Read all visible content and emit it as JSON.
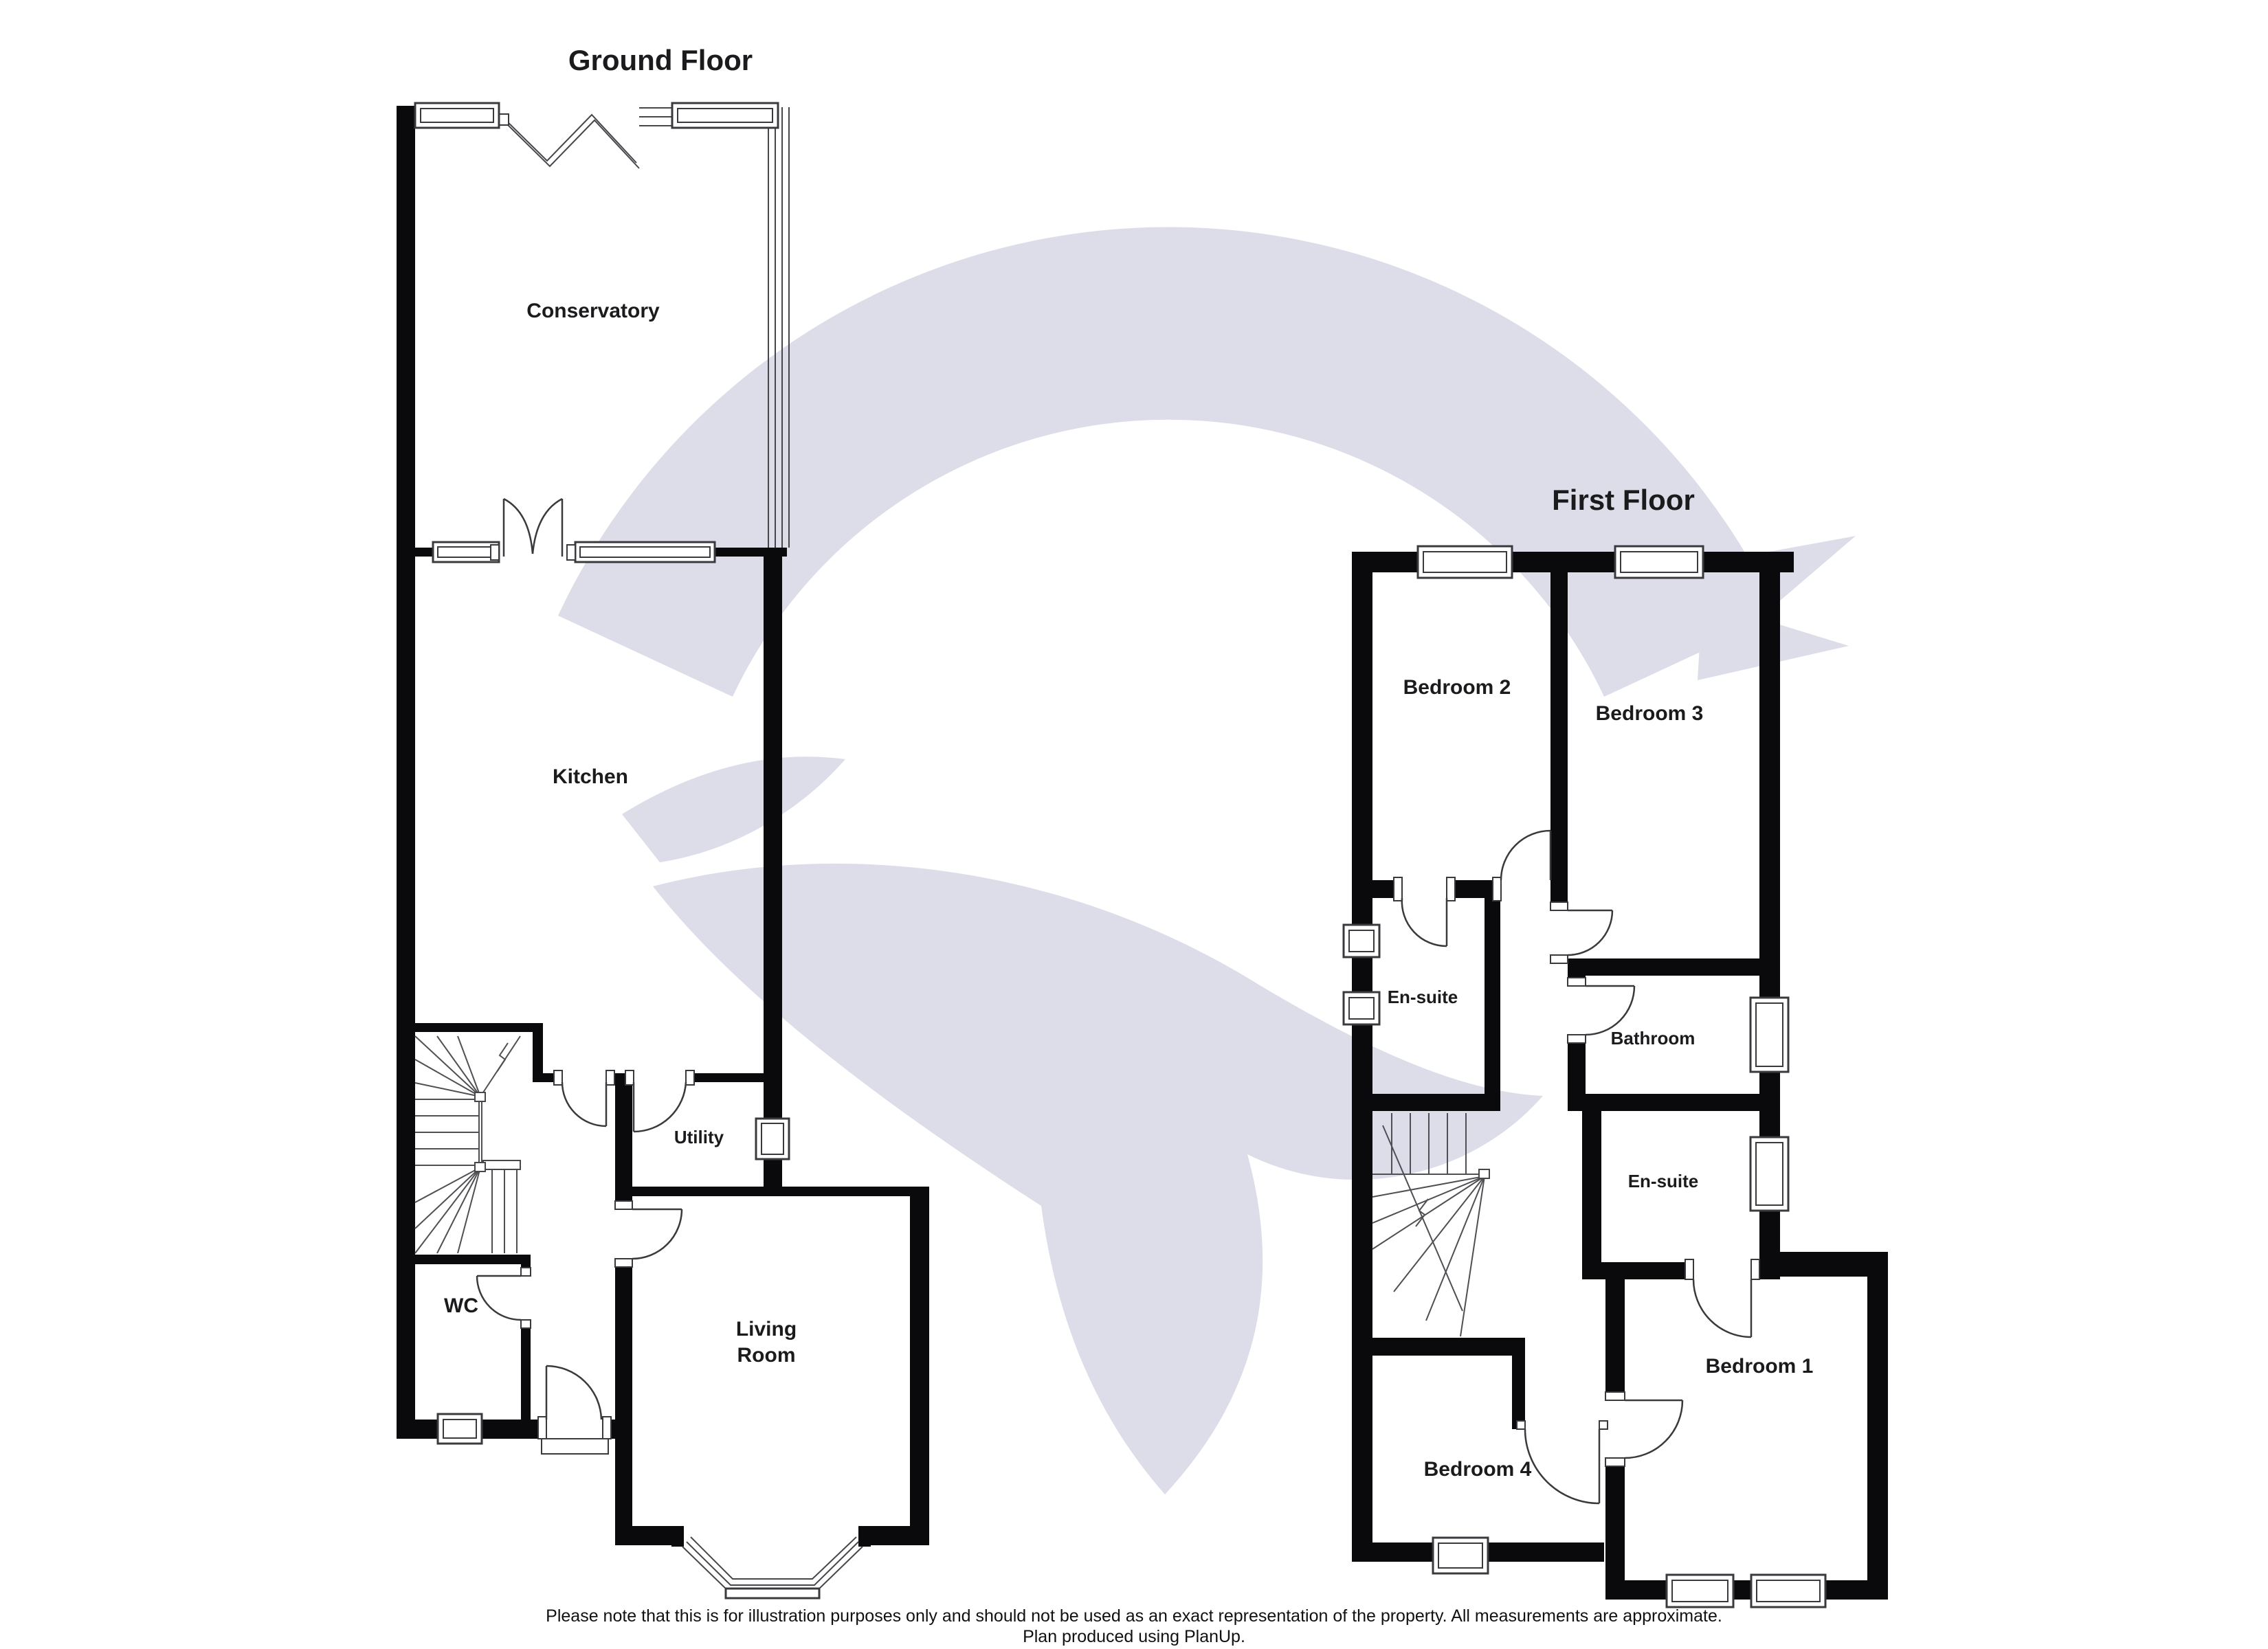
{
  "ground_floor": {
    "title": "Ground Floor",
    "rooms": {
      "conservatory": "Conservatory",
      "kitchen": "Kitchen",
      "utility": "Utility",
      "wc": "WC",
      "living_room_line1": "Living",
      "living_room_line2": "Room"
    }
  },
  "first_floor": {
    "title": "First Floor",
    "rooms": {
      "bedroom2": "Bedroom 2",
      "bedroom3": "Bedroom 3",
      "ensuite_top": "En-suite",
      "bathroom": "Bathroom",
      "ensuite_bottom": "En-suite",
      "bedroom4": "Bedroom 4",
      "bedroom1": "Bedroom 1"
    }
  },
  "footer": {
    "line1": "Please note that this is for illustration purposes only and should not be used as an exact representation of the property. All measurements are approximate.",
    "line2": "Plan produced using PlanUp."
  },
  "colors": {
    "wall": "#0a0a0c",
    "detail_line": "#3a3a3e",
    "watermark": "#dcdde8",
    "text": "#1b1b1d",
    "background": "#ffffff"
  }
}
